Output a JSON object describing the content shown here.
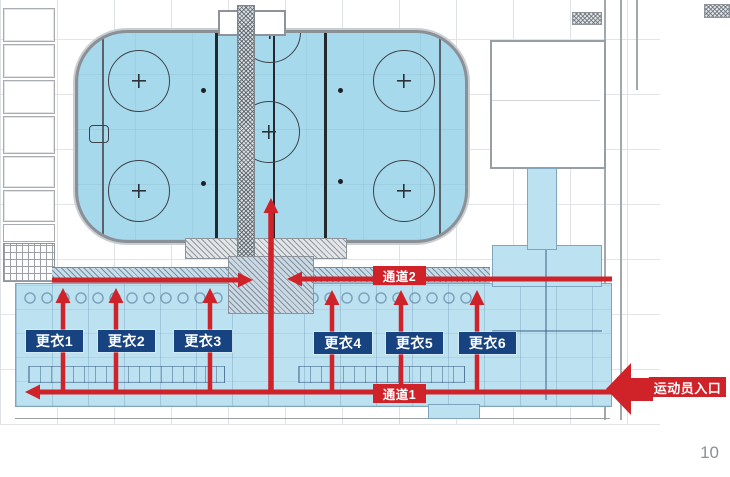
{
  "slide": {
    "page_number": "10"
  },
  "plan": {
    "changing_rooms": [
      {
        "label": "更衣1"
      },
      {
        "label": "更衣2"
      },
      {
        "label": "更衣3"
      },
      {
        "label": "更衣4"
      },
      {
        "label": "更衣5"
      },
      {
        "label": "更衣6"
      }
    ],
    "corridors": [
      {
        "label": "通道1"
      },
      {
        "label": "通道2"
      }
    ],
    "entrance": {
      "label": "运动员入口"
    }
  },
  "colors": {
    "rink_fill": "#A7D9EC",
    "zone_fill": "#BCE1F0",
    "route_red": "#CF2229",
    "label_navy": "#174380",
    "page_number_gray": "#8A9096"
  }
}
